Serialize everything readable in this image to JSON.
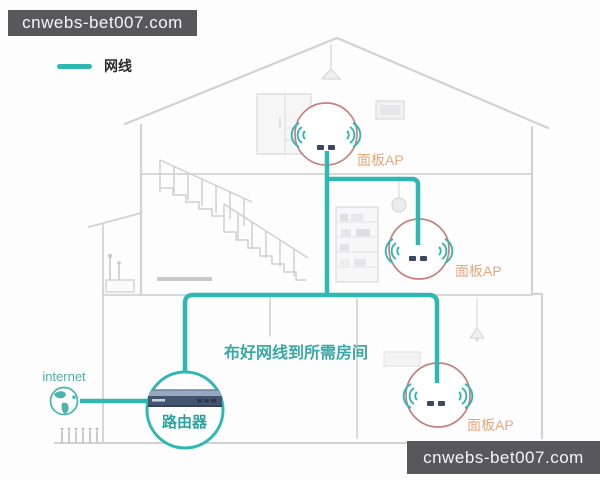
{
  "watermark_top": {
    "text": "cnwebs-bet007.com"
  },
  "watermark_bottom": {
    "text": "cnwebs-bet007.com"
  },
  "legend": {
    "cable_label": "网线"
  },
  "diagram": {
    "internet_label": "internet",
    "router_label": "路由器",
    "annotation": "布好网线到所需房间",
    "ap_labels": [
      "面板AP",
      "面板AP",
      "面板AP"
    ],
    "colors": {
      "cable": "#2fb8b2",
      "ap_circle_outline": "#c5817e",
      "ap_label": "#e8a87e",
      "router_circle": "#2fb8b2",
      "router_label": "#2ba39d",
      "annotation_text": "#3aa9a4",
      "house_lines": "#d5d5d7",
      "banner_background": "#58585a",
      "banner_text": "#f5f5f5"
    }
  }
}
